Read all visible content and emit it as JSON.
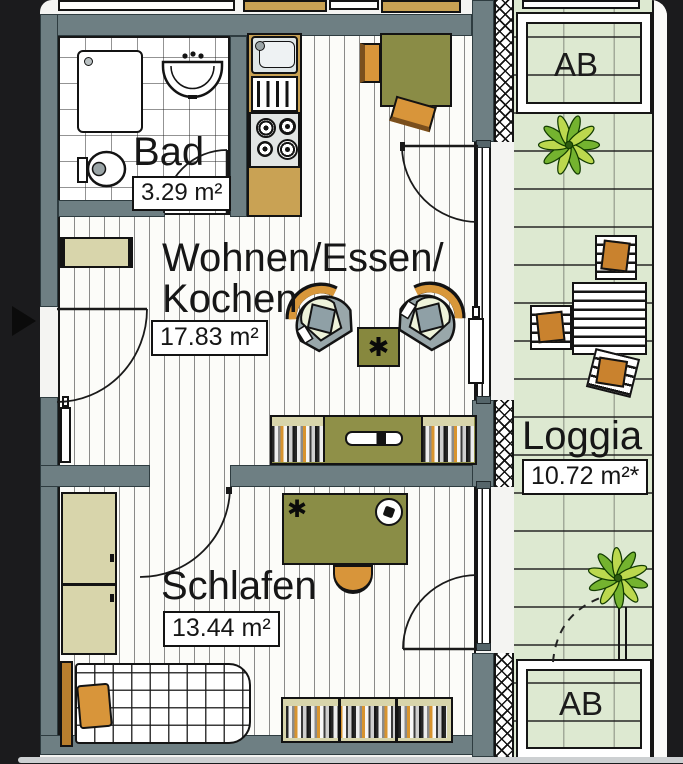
{
  "rooms": {
    "bad": {
      "label": "Bad",
      "area": "3.29 m²"
    },
    "wohnen": {
      "label_line1": "Wohnen/Essen/",
      "label_line2": "Kochen",
      "area": "17.83 m²"
    },
    "schlafen": {
      "label": "Schlafen",
      "area": "13.44 m²"
    },
    "loggia": {
      "label": "Loggia",
      "area": "10.72 m²*"
    },
    "ab_top": {
      "label": "AB"
    },
    "ab_bottom": {
      "label": "AB"
    }
  },
  "glyphs": {
    "star": "✱"
  },
  "colors": {
    "wall": "#6e7f83",
    "loggia_floor": "#dde9d1",
    "furniture_olive": "#8a8c46",
    "wood_orange": "#d8953a",
    "cabinet_beige": "#d8d5ab",
    "counter_tan": "#c9a254",
    "plant_green": "#74b32f",
    "background": "#1b1b1d"
  }
}
